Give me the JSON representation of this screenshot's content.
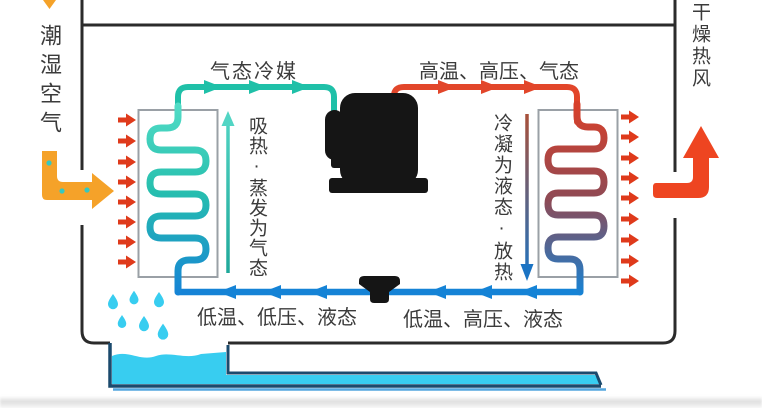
{
  "canvas": {
    "width": 762,
    "height": 408,
    "background": "#ffffff"
  },
  "labels": {
    "humid_air": "潮湿空气",
    "dry_hot_air": "干燥热风",
    "gas_refrigerant": "气态冷媒",
    "compressor_outlet": "高温、高压、气态",
    "evaporator_note": "吸热·蒸发为气态",
    "condenser_note": "冷凝为液态·放热",
    "liquid_low_pressure": "低温、低压、液态",
    "liquid_high_pressure": "低温、高压、液态"
  },
  "shapes": {
    "compressor": "compressor",
    "expansion_valve": "expansion-valve",
    "evaporator": "evaporator-coil",
    "condenser": "condenser-coil",
    "water_tray": "condensate-tray-with-drain",
    "water_drops": "condensate-droplets"
  },
  "colors": {
    "cabinet_outline": "#2b2b2b",
    "coil_box_border": "#9aa0a6",
    "pipe_gas": "#1fc0a8",
    "pipe_hot": "#e2462a",
    "pipe_liquid": "#1583d6",
    "evap_coil_top": "#52dcc6",
    "evap_coil_mid": "#27bfae",
    "cond_coil_top": "#d8402a",
    "cond_coil_mid": "#8e4a55",
    "airflow_arrow": "#df3a1b",
    "inlet_arrow_orange": "#f5a229",
    "outlet_arrow_red": "#ee4521",
    "water_cyan": "#38cdf0",
    "moisture_dot": "#35c8c0",
    "tray_outline": "#1b4a6d",
    "tray_underline": "#54a6dd",
    "component_black": "#151515",
    "text": "#3b3b3b",
    "note_up_top": "#52d5c4",
    "note_up_bottom": "#1fa89a",
    "note_down_top": "#a8503a",
    "note_down_bottom": "#1b74c4"
  }
}
